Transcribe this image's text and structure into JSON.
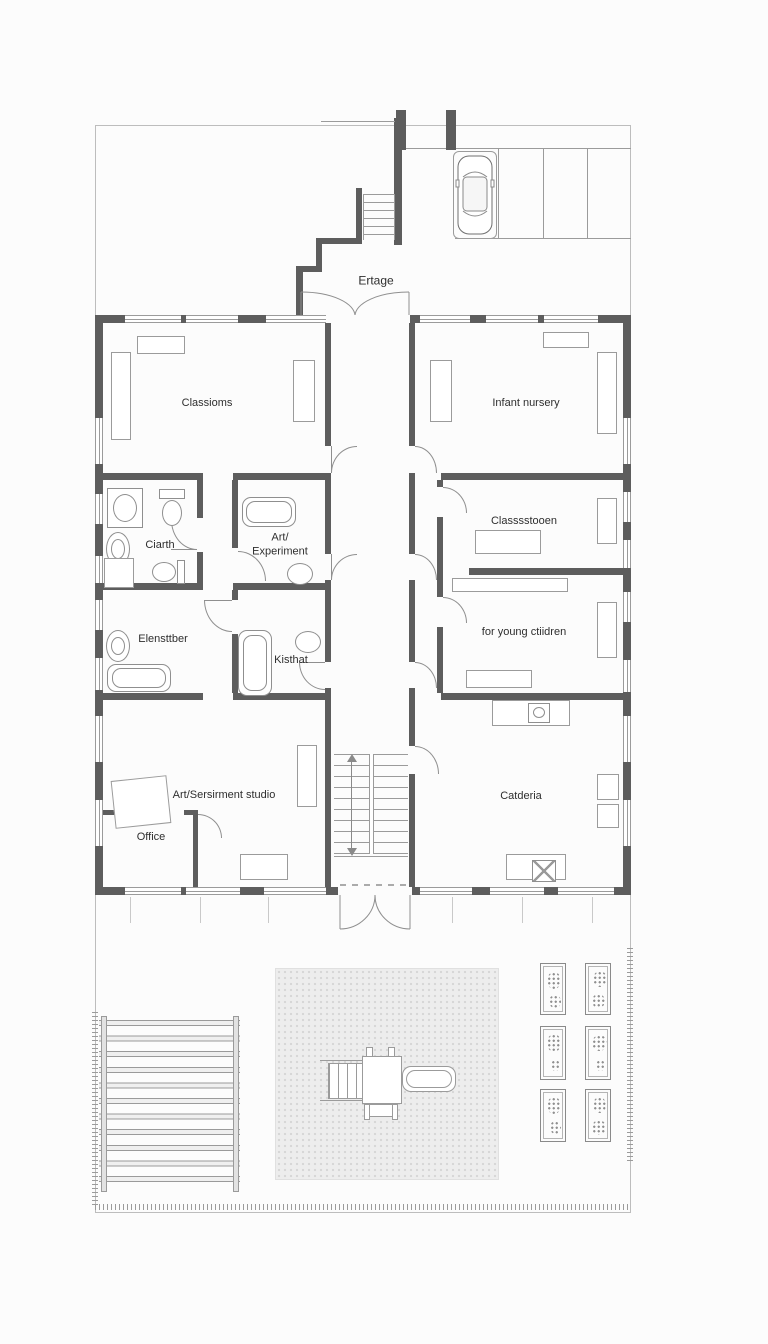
{
  "labels": {
    "entrance": "Ertage",
    "classrooms": "Classioms",
    "infant_nursery": "Infant nursery",
    "bath": "Ciarth",
    "art_experiment_1": "Art/",
    "art_experiment_2": "Experiment",
    "classroom_east": "Classsstooen",
    "changing_room": "Elensttber",
    "kitchen": "Kisthat",
    "young_children": "for young ctiidren",
    "art_studio": "Art/Sersirment studio",
    "office": "Office",
    "cafeteria": "Catderia"
  },
  "colors": {
    "wall": "#5d5d5d",
    "thin_line": "#9b9b9b",
    "label_text": "#2e2e2e",
    "playground_fill": "#ededed",
    "page_background": "#fcfcfc"
  }
}
